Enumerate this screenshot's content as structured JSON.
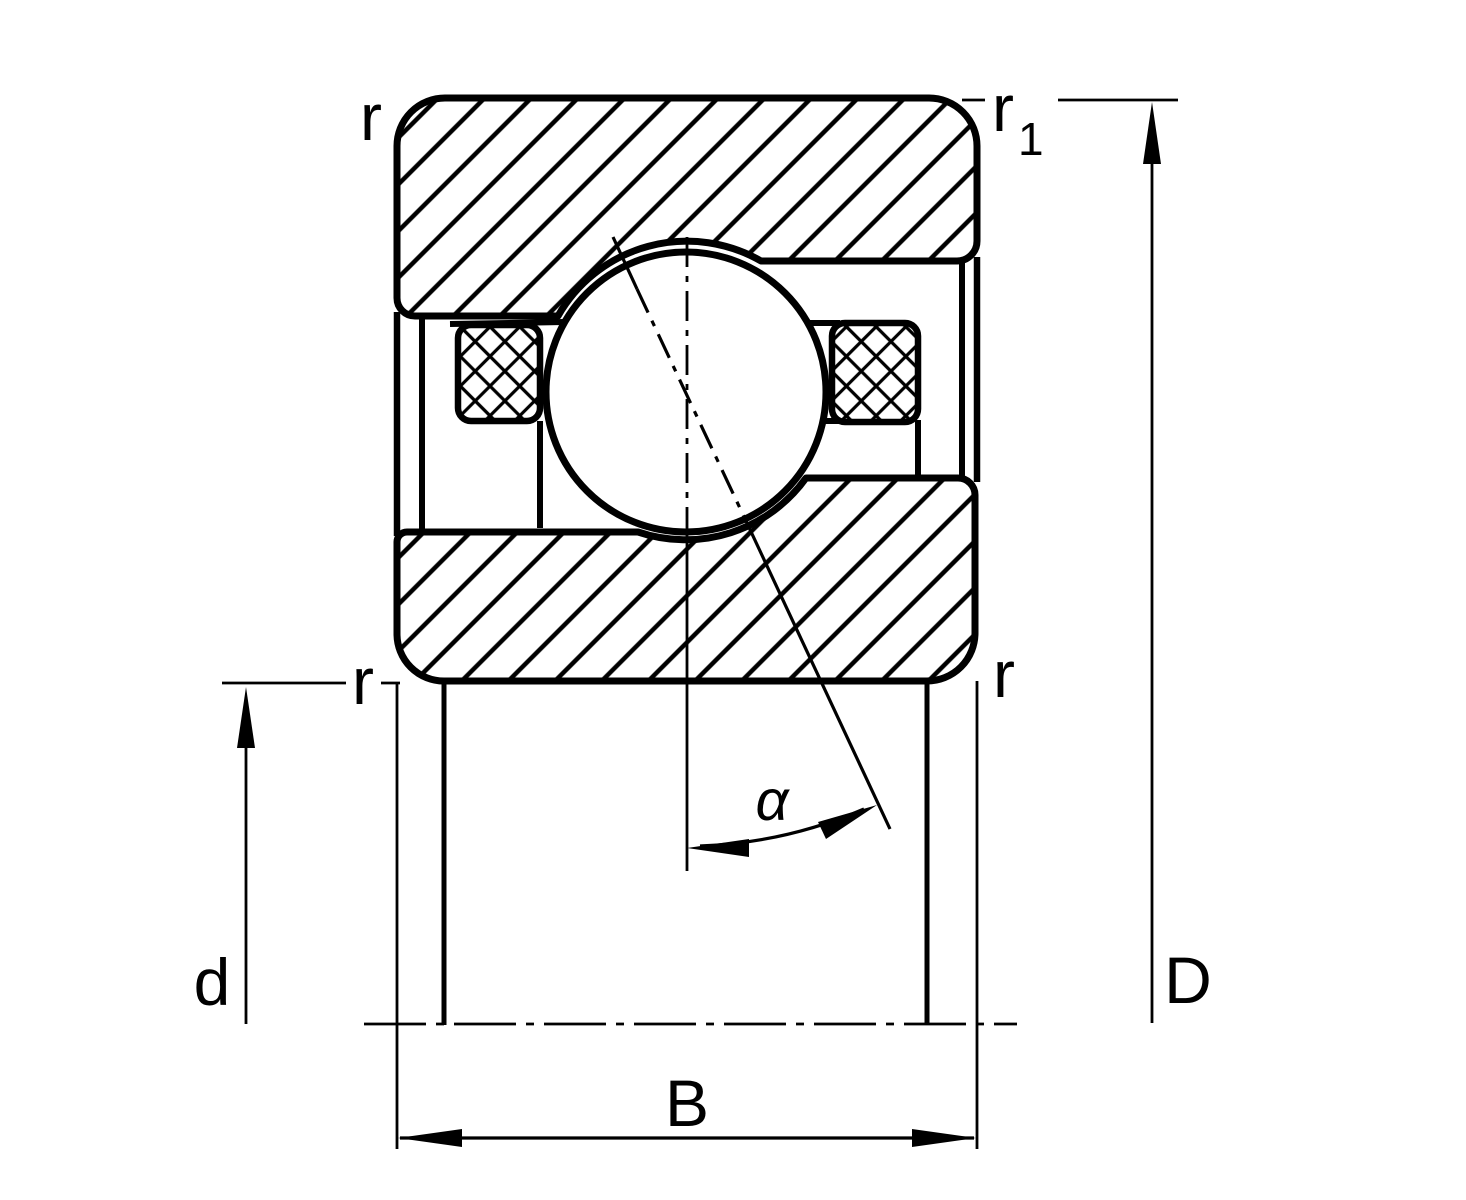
{
  "drawing": {
    "type": "angular-contact-ball-bearing-cross-section",
    "background_color": "#ffffff",
    "line_color": "#000000",
    "labels": {
      "outer_ring_corner_radius_top_left": "r",
      "outer_ring_corner_radius_top_right_base": "r",
      "outer_ring_corner_radius_top_right_subscript": "1",
      "inner_ring_corner_radius_left": "r",
      "inner_ring_corner_radius_right": "r",
      "bore_diameter": "d",
      "outside_diameter": "D",
      "bearing_width": "B",
      "contact_angle": "α"
    }
  }
}
